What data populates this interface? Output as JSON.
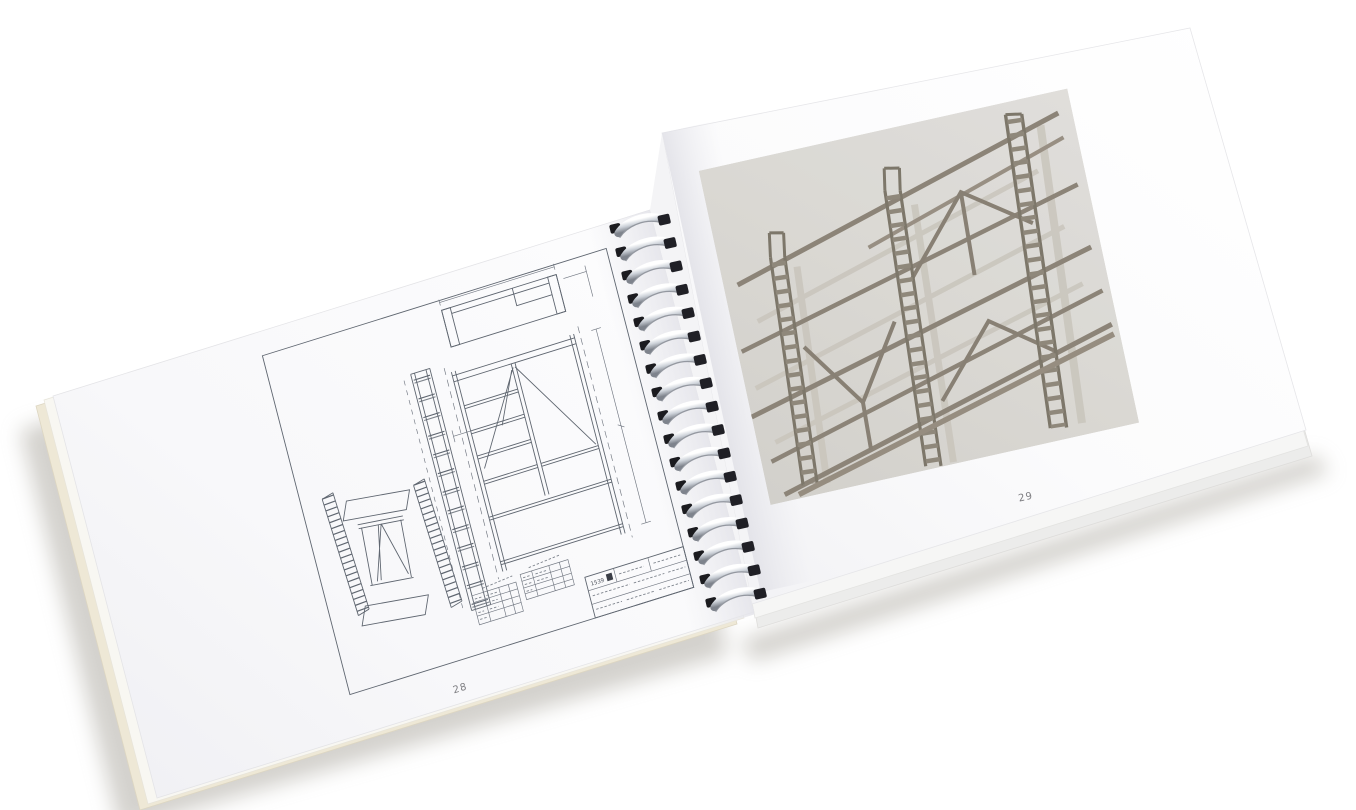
{
  "book": {
    "left_page": {
      "page_number": "28"
    },
    "right_page": {
      "page_number": "29"
    },
    "binding": {
      "loop_count": 17,
      "wire_color": "#d7dade",
      "tip_color": "#1b1b1f"
    },
    "title_block": {
      "code": "1539"
    },
    "colors": {
      "background": "#ffffff",
      "paper": "#fcfcfd",
      "paper_shade": "#eeeef2",
      "under_sheet_cream": "#eee8d6",
      "shadow": "#a8a49b",
      "drawing_line": "#5f6670",
      "photo_background": "#dcdbd6",
      "wood": "#8a8275",
      "wood_shadow": "#cbc7be"
    }
  }
}
